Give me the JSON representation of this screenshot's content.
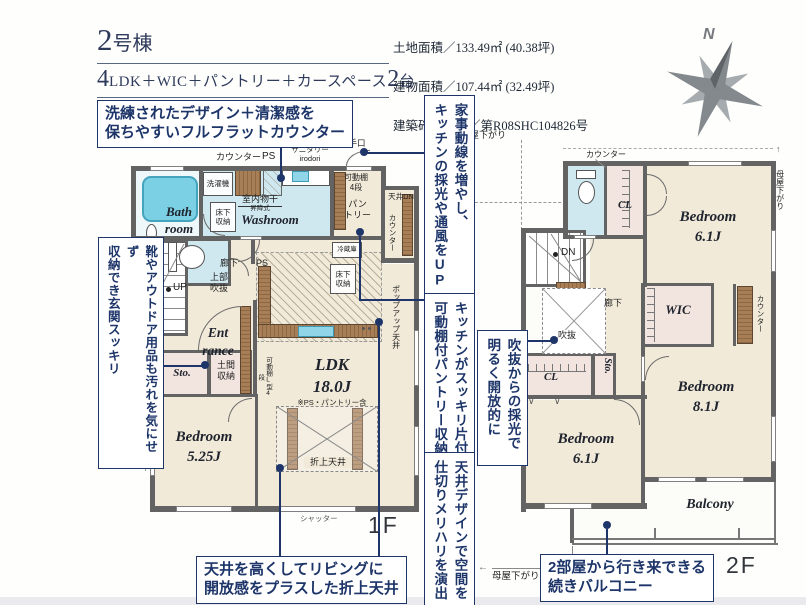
{
  "header": {
    "building_no": "2",
    "building_suffix": "号棟",
    "plan_big1": "4",
    "plan_text": "LDK＋WIC＋パントリー＋カースペース",
    "plan_big2": "2",
    "plan_tail": "台",
    "land_area": "土地面積／133.49㎡ (40.38坪)",
    "building_area": "建物面積／107.44㎡ (32.49坪)",
    "permit": "建築確認番号／第R08SHC104826号",
    "compass_north": "N"
  },
  "callouts": {
    "flat_counter": "洗練されたデザイン＋清潔感を\n保ちやすいフルフラットカウンター",
    "genkan": "靴やアウトドア用品も汚れを気にせず\n収納でき玄関スッキリ",
    "kaji_dousen": "家事動線を増やし、\nキッチンの採光や通風をUP",
    "pantry": "キッチンがスッキリ片付く\n可動棚付パントリー収納",
    "fukinuke": "吹抜からの採光で\n明るく開放的に",
    "ceiling_design": "天井デザインで空間を\n仕切りメリハリを演出",
    "oriage_ceiling": "天井を高くしてリビングに\n開放感をプラスした折上天井",
    "balcony": "2部屋から行き来できる\n続きバルコニー"
  },
  "floor1": {
    "floor_label": "1F",
    "bath": "Bath\nroom",
    "washroom": "Washroom",
    "entrance": "Ent\nrance",
    "sto": "Sto.",
    "ldk": "LDK\n18.0J",
    "ldk_note": "※PS・パントリー含",
    "bedroom": "Bedroom\n5.25J",
    "counter": "カウンター",
    "ps_top": "PS",
    "open_sanitary": "オープン\nサニタリー\nirodori",
    "katteguchi": "勝手口",
    "washer": "洗濯機",
    "monohoshi": "室内物干",
    "monohoshi_sub": "昇降式",
    "yukashita": "床下\n収納",
    "kadoudana": "可動棚\n4段",
    "pantry": "パン\nトリー",
    "tenjo_dn": "天井DN",
    "counter_v": "カウンター",
    "reizoko": "冷蔵庫",
    "rouka": "廊下",
    "ps2": "PS",
    "joubu_fukinuke": "上部\n吹抜",
    "up": "UP",
    "yukashita2": "床下\n収納",
    "popup": "ポップアップ天井",
    "doma": "土間\n収納",
    "kadou_l": "可動棚L型4段",
    "shutter_left": "シャッター",
    "shutter_bottom": "シャッター",
    "oriage": "折上天井"
  },
  "floor2": {
    "floor_label": "2F",
    "bedroom_a": "Bedroom\n6.1J",
    "bedroom_b": "Bedroom\n8.1J",
    "bedroom_c": "Bedroom\n6.1J",
    "wic": "WIC",
    "cl1": "CL",
    "cl2": "CL",
    "sto": "Sto.",
    "balcony": "Balcony",
    "counter_top": "カウンター",
    "counter_v": "カウンター",
    "dn": "DN",
    "rouka": "廊下",
    "fukinuke": "吹抜",
    "moya_top": "母屋下がり",
    "moya_left": "母屋下がり",
    "moya_right": "母屋下がり",
    "moya_bottom": "母屋下がり",
    "arrow_left": "←",
    "arrow_up": "↑"
  }
}
